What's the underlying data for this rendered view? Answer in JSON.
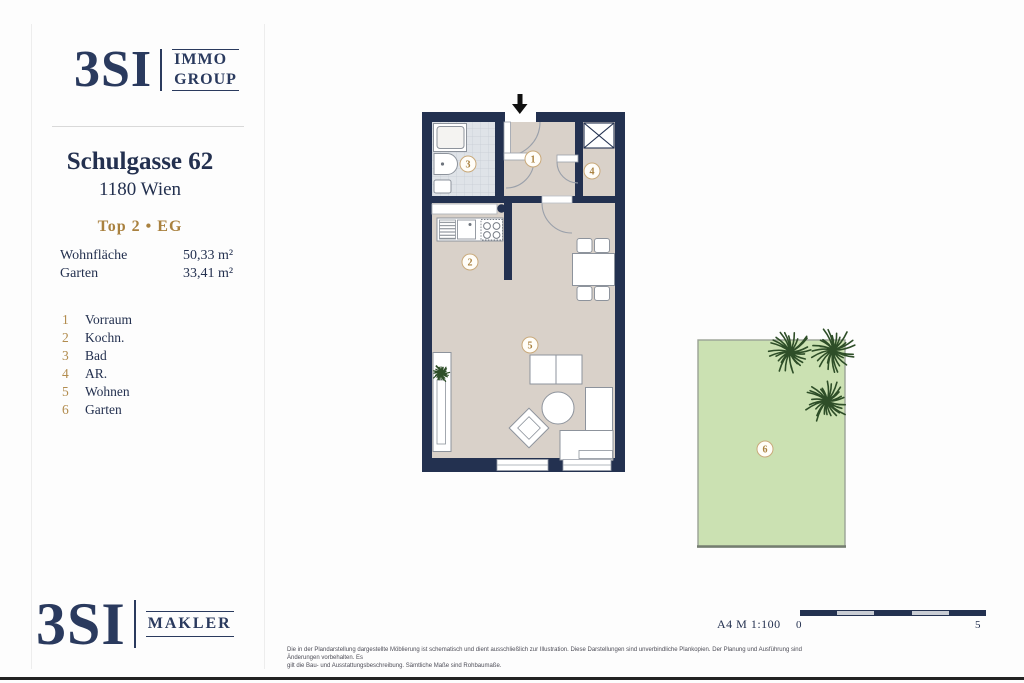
{
  "branding": {
    "logo_top": {
      "wordmark": "3SI",
      "suffix_line1": "IMMO",
      "suffix_line2": "GROUP"
    },
    "logo_bottom": {
      "wordmark": "3SI",
      "suffix": "MAKLER"
    }
  },
  "header": {
    "street": "Schulgasse 62",
    "city": "1180 Wien",
    "unit": "Top 2 •  EG"
  },
  "areas": [
    {
      "label": "Wohnfläche",
      "value": "50,33 m²"
    },
    {
      "label": "Garten",
      "value": "33,41 m²"
    }
  ],
  "legend": [
    {
      "num": "1",
      "label": "Vorraum"
    },
    {
      "num": "2",
      "label": "Kochn."
    },
    {
      "num": "3",
      "label": "Bad"
    },
    {
      "num": "4",
      "label": "AR."
    },
    {
      "num": "5",
      "label": "Wohnen"
    },
    {
      "num": "6",
      "label": "Garten"
    }
  ],
  "footer": {
    "sheet_info": "A4  M 1:100",
    "scale_min": "0",
    "scale_max": "5",
    "disclaimer_line1": "Die in der Plandarstellung dargestellte Möblierung ist schematisch und dient ausschließlich zur Illustration. Diese Darstellungen sind unverbindliche Plankopien. Der Planung und Ausführung sind Änderungen vorbehalten. Es",
    "disclaimer_line2": "gilt die Bau- und Ausstattungsbeschreibung. Sämtliche Maße sind Rohbaumaße."
  },
  "colors": {
    "navy": "#233150",
    "gold": "#a9813f",
    "floor_beige": "#d9d1c9",
    "bath_tile": "#dfe3e8",
    "garden_green": "#cbe1b2",
    "tree_green": "#2e4e28"
  }
}
